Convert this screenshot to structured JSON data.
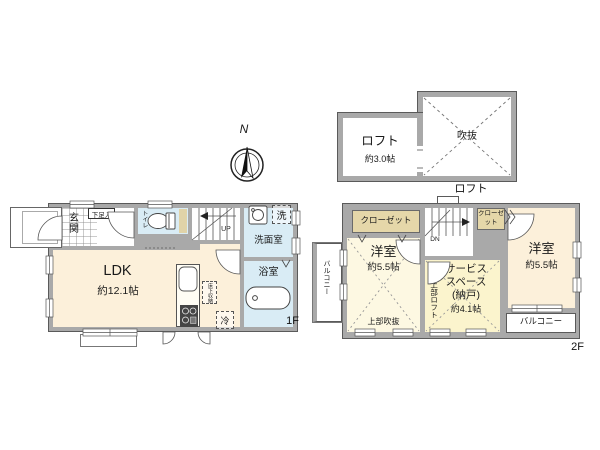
{
  "palette": {
    "wall": "#a9a9a9",
    "outline": "#5a5a5a",
    "wet_area": "#d9ecf5",
    "ldk_floor": "#fcf0da",
    "room_floor": "#fdf8e2",
    "service_floor": "#fbf4cd",
    "closet": "#e5d7a9"
  },
  "compass": {
    "north_label": "N"
  },
  "loft_plan": {
    "caption": "ロフト",
    "loft": {
      "name": "ロフト",
      "size": "約3.0帖"
    },
    "void": {
      "name": "吹抜"
    }
  },
  "floor1": {
    "caption": "1F",
    "entrance": {
      "name": "玄関",
      "shoe_cabinet": "下足入"
    },
    "toilet": {
      "name": "トイレ"
    },
    "stairs": {
      "direction": "UP"
    },
    "washroom": {
      "name": "洗面室",
      "washer_mark": "洗"
    },
    "bathroom": {
      "name": "浴室"
    },
    "ldk": {
      "name": "LDK",
      "size": "約12.1帖"
    },
    "underfloor_storage": "床下収納",
    "refrigerator": "冷"
  },
  "floor2": {
    "caption": "2F",
    "closet_left": "クローゼット",
    "closet_right": "クローゼット",
    "stairs": {
      "direction": "DN"
    },
    "bedroom_west": {
      "name": "洋室",
      "size": "約5.5帖",
      "note": "上部吹抜"
    },
    "service_space": {
      "name_line1": "サービス",
      "name_line2": "スペース",
      "name_line3": "(納戸)",
      "size": "約4.1帖",
      "note": "上部ロフト"
    },
    "bedroom_east": {
      "name": "洋室",
      "size": "約5.5帖"
    },
    "balcony_west": "バルコニー",
    "balcony_south": "バルコニー"
  }
}
